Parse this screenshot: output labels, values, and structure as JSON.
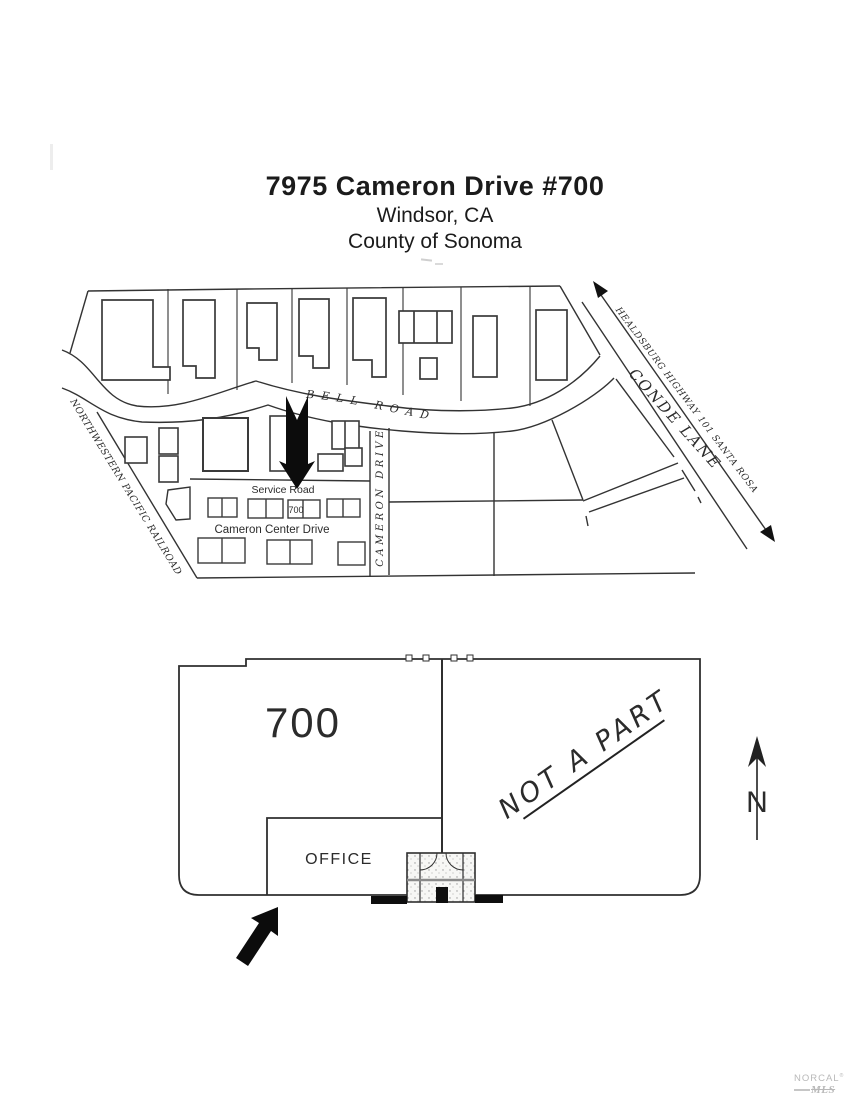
{
  "title": {
    "line1": "7975 Cameron Drive #700",
    "line2": "Windsor, CA",
    "line3": "County of Sonoma"
  },
  "site_map": {
    "labels": {
      "bell_road": "BELL ROAD",
      "conde_lane": "CONDE LANE",
      "highway": "HEALDSBURG  HIGHWAY 101  SANTA ROSA",
      "railroad": "NORTHWESTERN PACIFIC RAILROAD",
      "service_road": "Service Road",
      "cameron_center_drive": "Cameron Center Drive",
      "cameron_drive": "CAMERON DRIVE",
      "unit_number": "700"
    }
  },
  "floor_plan": {
    "unit_label": "700",
    "office_label": "OFFICE",
    "not_a_part": "NOT A PART",
    "north_label": "N"
  },
  "footer_logo": {
    "brand": "NORCAL",
    "reg": "®",
    "sub": "MLS"
  }
}
